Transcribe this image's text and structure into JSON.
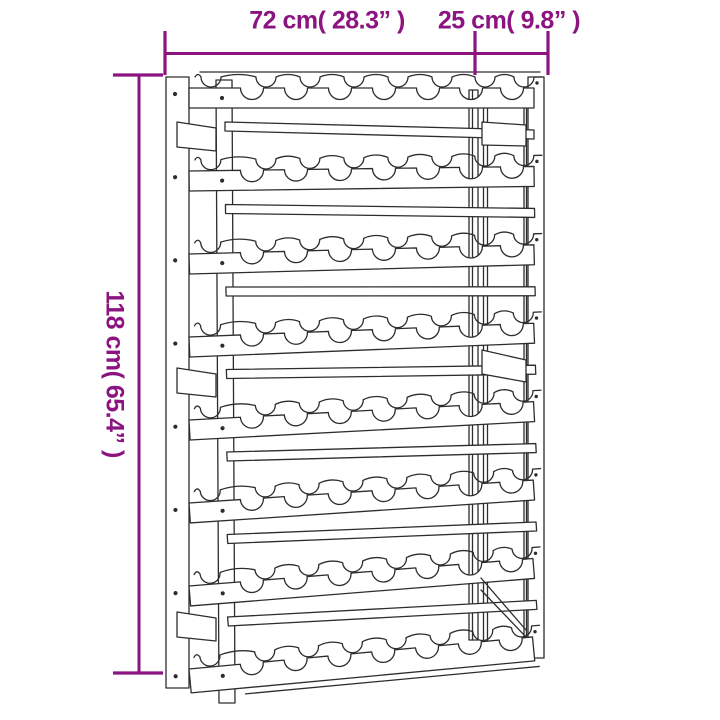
{
  "page": {
    "background_color": "#ffffff"
  },
  "diagram": {
    "subject": "wine-rack-dimension-line-drawing",
    "accent_color": "#8B1480",
    "drawing_line_color": "#2D2D2D",
    "labels": {
      "width": "72 cm( 28.3” )",
      "depth": "25 cm( 9.8” )",
      "height": "118 cm( 65.4” )"
    },
    "rack": {
      "shelf_rows": 8,
      "bottle_scallops_per_row": 7
    }
  }
}
